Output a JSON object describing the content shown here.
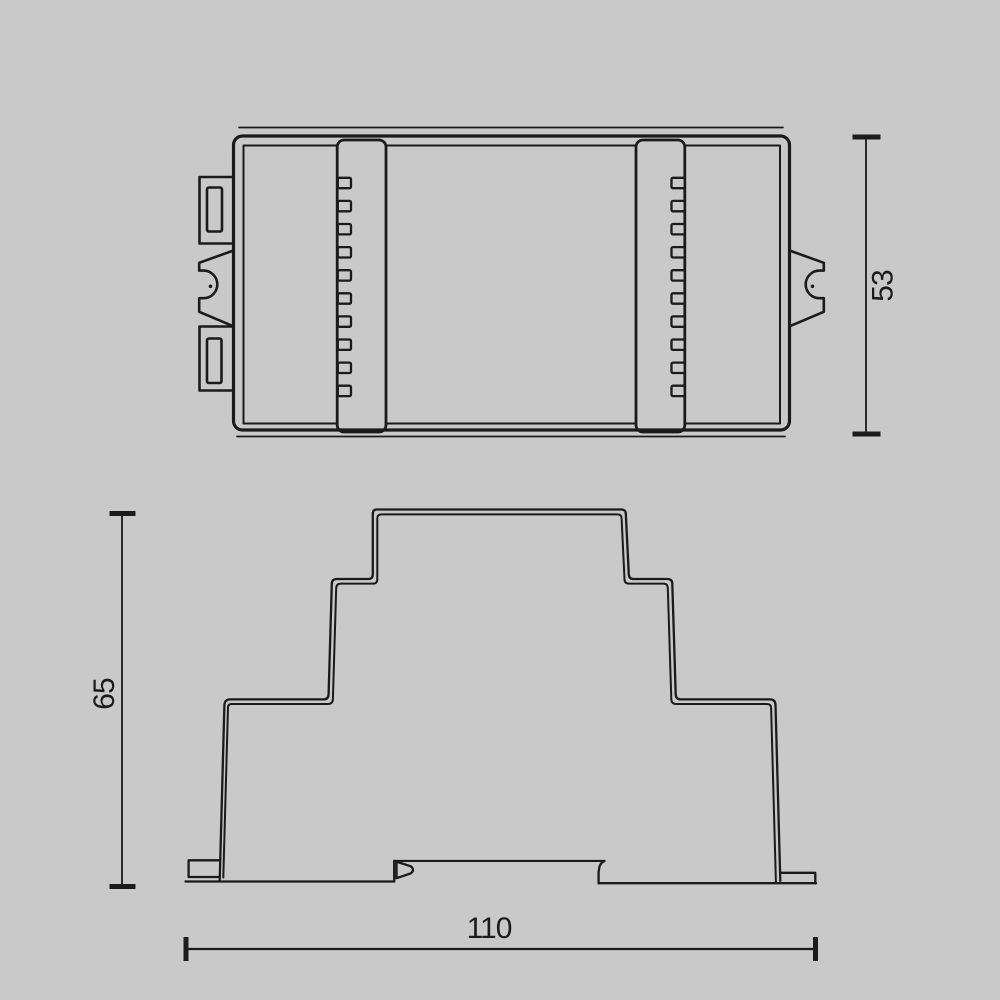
{
  "drawing": {
    "background_color": "#c9c9c9",
    "line_color": "#1b1b1b",
    "description": "Technical dimensional drawing of a DIN-rail electronic module, top view and side profile view",
    "dimensions": {
      "depth": "53",
      "height": "65",
      "width": "110"
    },
    "terminal_slots": {
      "count_per_side": 10,
      "first_y": 177.8,
      "pitch": 23.1,
      "slot_height": 10.4,
      "left_x": 337.8,
      "right_x": 671.5,
      "slot_width": 13.2
    }
  }
}
